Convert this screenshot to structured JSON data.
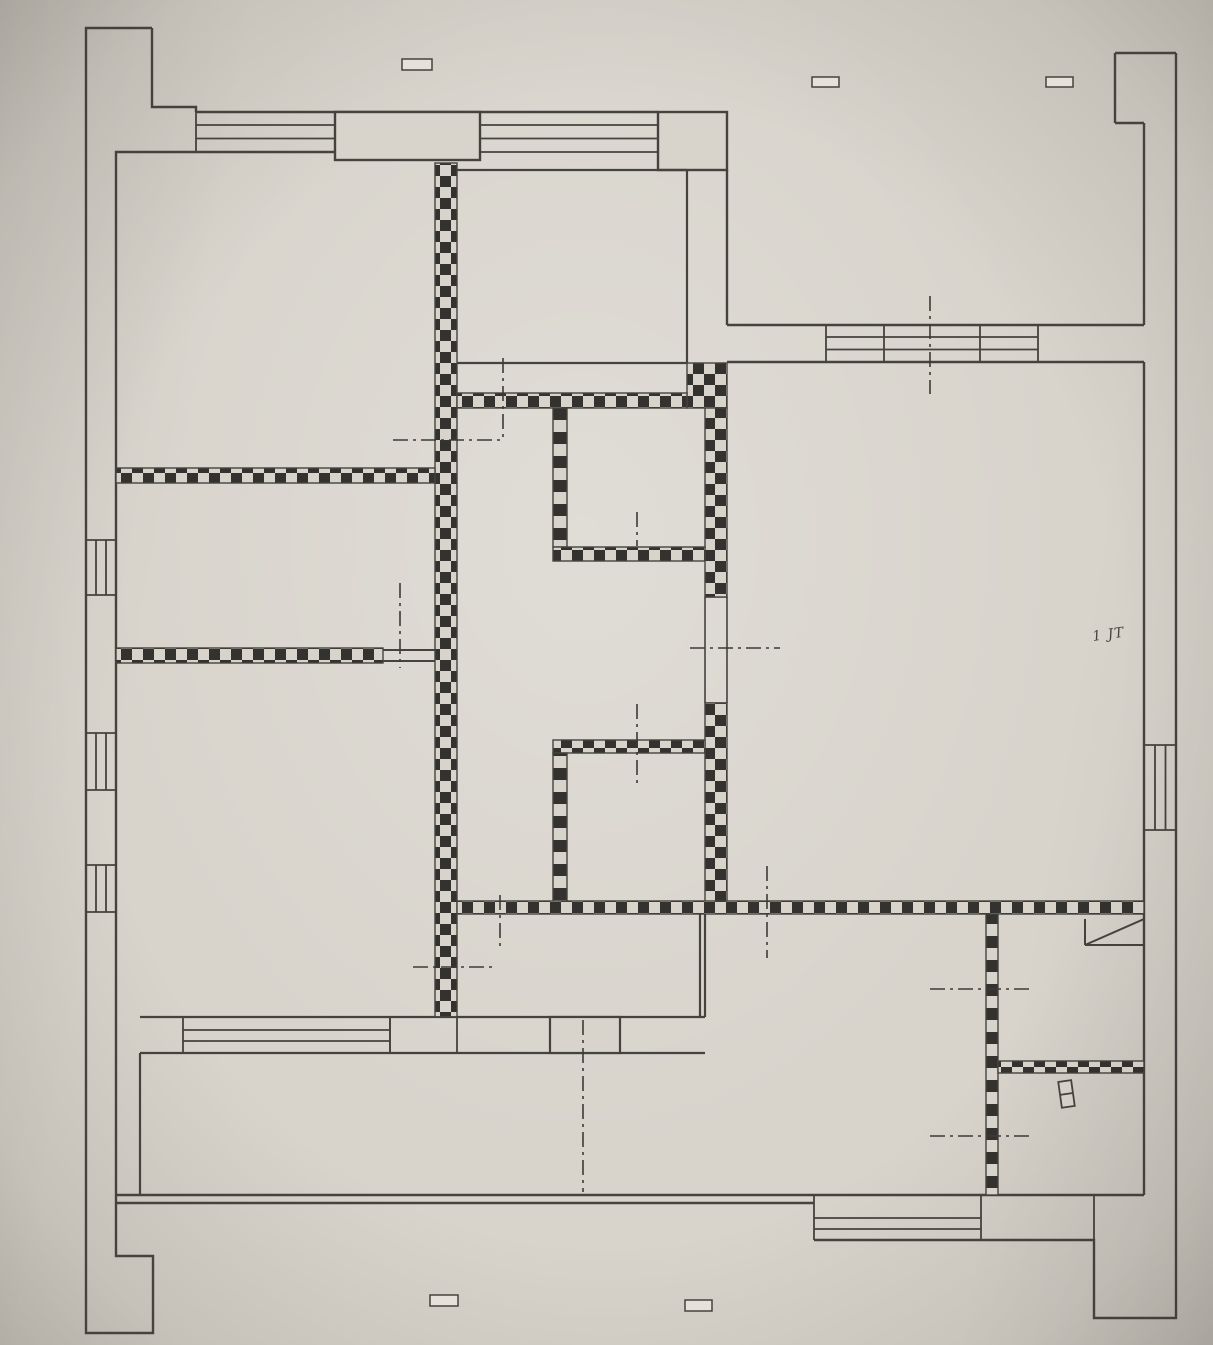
{
  "document": {
    "kind": "photographed hand-drafted floor plan",
    "annotation": "1 JT"
  },
  "colors": {
    "paper": "#d8d4cc",
    "line": "#45433e",
    "checker": "#34322e",
    "axis": "#3d3b37",
    "marker_fill": "#e6e2da"
  },
  "legend": {
    "checkered_wall": "masonry wall to demolish/build (checker hatch)",
    "window_band": "window (parallel line band)",
    "axis_line": "dash-dot opening axis",
    "duct_symbol": "shaft with diagonal",
    "door_leaf_symbol": "small door leaf"
  },
  "markers": [
    {
      "name": "tape-marker-top-left"
    },
    {
      "name": "tape-marker-top-center"
    },
    {
      "name": "tape-marker-top-right"
    },
    {
      "name": "tape-marker-bottom-left"
    },
    {
      "name": "tape-marker-bottom-center"
    }
  ]
}
